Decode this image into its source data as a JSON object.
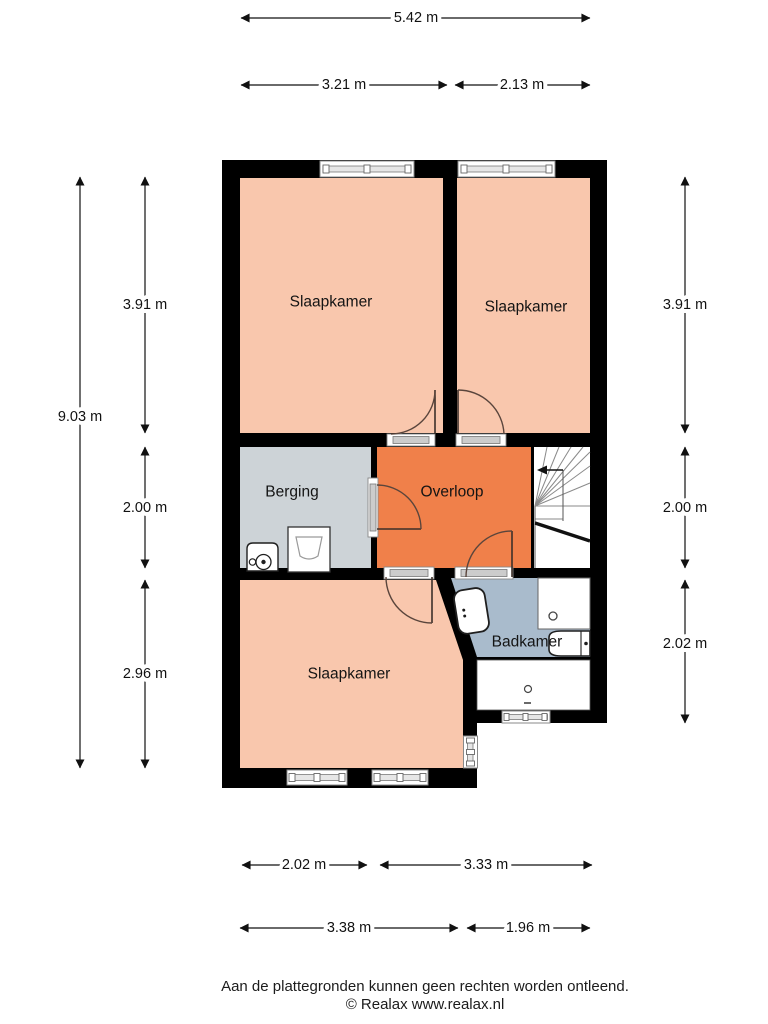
{
  "rooms": {
    "bedroom_top_left": "Slaapkamer",
    "bedroom_top_right": "Slaapkamer",
    "bedroom_bottom": "Slaapkamer",
    "storage": "Berging",
    "landing": "Overloop",
    "bathroom": "Badkamer"
  },
  "dimensions": {
    "top_total": "5.42 m",
    "top_left": "3.21 m",
    "top_right": "2.13 m",
    "left_total": "9.03 m",
    "left_top": "3.91 m",
    "left_middle": "2.00 m",
    "left_bottom": "2.96 m",
    "right_top": "3.91 m",
    "right_middle": "2.00 m",
    "right_bottom": "2.02 m",
    "bottom_row1_left": "2.02 m",
    "bottom_row1_right": "3.33 m",
    "bottom_row2_left": "3.38 m",
    "bottom_row2_right": "1.96 m"
  },
  "footer": {
    "disclaimer": "Aan de plattegronden kunnen geen rechten worden ontleend.",
    "copyright": "© Realax www.realax.nl"
  },
  "colors": {
    "wall": "#000000",
    "bedroom": "#f9c7ad",
    "landing": "#f0804a",
    "storage": "#cdd3d7",
    "bathroom": "#a9bbcc",
    "floor_white": "#ffffff"
  },
  "icons": {
    "fixtures": [
      "toilet",
      "shower-drain",
      "bathtub",
      "washing-machine",
      "laundry-sink",
      "stairs-up-arrow"
    ]
  }
}
